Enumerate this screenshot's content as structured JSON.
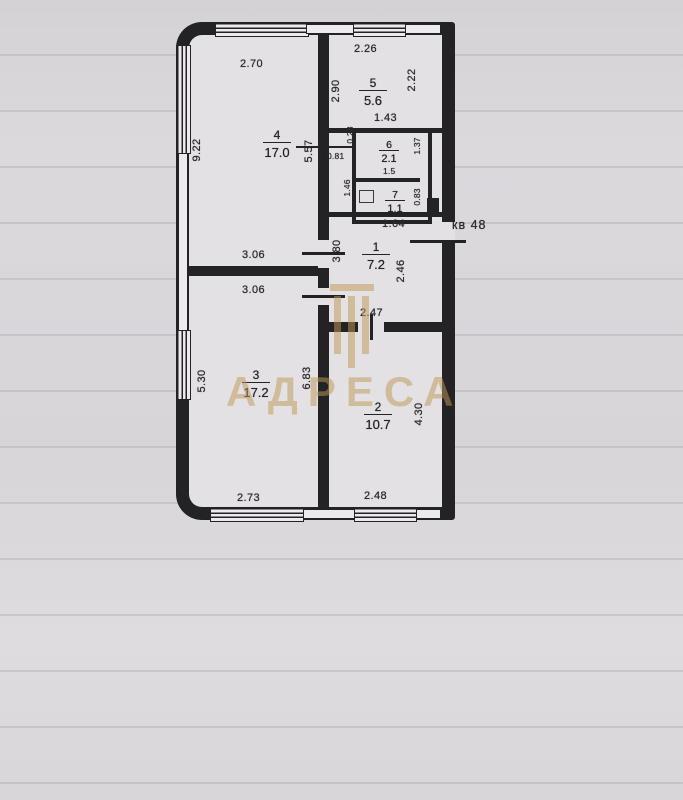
{
  "apartment_label": "кв 48",
  "watermark": {
    "text": "АДРЕСА",
    "logo": "building-columns-logo"
  },
  "rooms": {
    "r1": {
      "number": "1",
      "area": "7.2"
    },
    "r2": {
      "number": "2",
      "area": "10.7"
    },
    "r3": {
      "number": "3",
      "area": "17.2"
    },
    "r4": {
      "number": "4",
      "area": "17.0"
    },
    "r5": {
      "number": "5",
      "area": "5.6"
    },
    "r6": {
      "number": "6",
      "area": "2.1"
    },
    "r7": {
      "number": "7",
      "area": "1.1"
    }
  },
  "dimensions": {
    "room4_top": "2.70",
    "room4_left": "9.22",
    "room4_right": "5.57",
    "room4_bottom": "3.06",
    "room5_top": "2.26",
    "room5_left": "2.90",
    "room5_right": "2.22",
    "bath_top": "1.43",
    "bath_right": "1.37",
    "bath_inner": "1.5",
    "closet_top": "0.28",
    "closet_width": "0.81",
    "closet_height": "1.46",
    "toilet_bottom": "1.64",
    "toilet_right": "0.83",
    "hall_left": "3.80",
    "hall_right": "2.46",
    "hall_bottom": "2.47",
    "room3_top": "3.06",
    "room3_left": "5.30",
    "room3_right": "6.83",
    "room3_bottom": "2.73",
    "room2_right": "4.30",
    "room2_bottom": "2.48"
  },
  "colors": {
    "ink": "#232225",
    "paper": "#d8d6d9",
    "watermark": "#bc9654"
  }
}
